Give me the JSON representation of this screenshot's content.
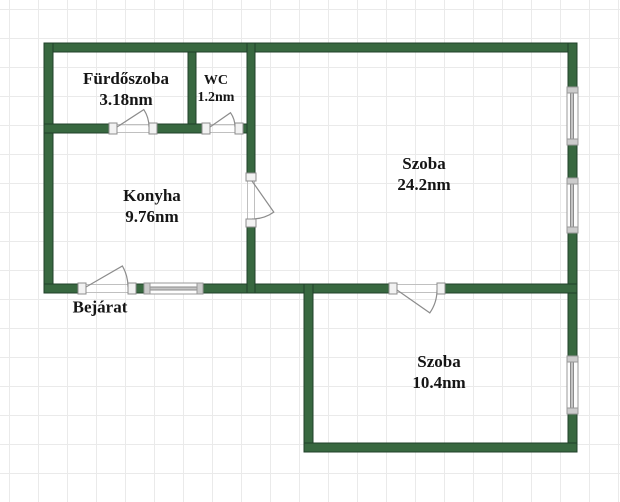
{
  "plan": {
    "canvas": {
      "width": 620,
      "height": 502
    },
    "grid": {
      "size": 29,
      "offset": 9,
      "color": "#eaeaea",
      "background": "#ffffff"
    },
    "style": {
      "wall_fill": "#386840",
      "wall_stroke": "#20402a",
      "label_color": "#151515",
      "symbol_stroke": "#8c8c8c",
      "symbol_fill": "#f2f2f2",
      "edge_line": "#c0c0c0",
      "window_frame_stroke": "#999999",
      "window_frame_fill": "#fdfdfd",
      "window_cap_fill": "#cccccc",
      "window_glass_fill": "#c4c4c4",
      "line_height_factor": 1.24
    },
    "rooms": [
      {
        "name": "Fürdőszoba",
        "area": "3.18nm",
        "cx": 126,
        "cy": 89,
        "fs": 17
      },
      {
        "name": "WC",
        "area": "1.2nm",
        "cx": 216,
        "cy": 89,
        "fs": 14
      },
      {
        "name": "Konyha",
        "area": "9.76nm",
        "cx": 152,
        "cy": 206,
        "fs": 17
      },
      {
        "name": "Szoba",
        "area": "24.2nm",
        "cx": 424,
        "cy": 174,
        "fs": 17
      },
      {
        "name": "Szoba",
        "area": "10.4nm",
        "cx": 439,
        "cy": 372,
        "fs": 17
      },
      {
        "name": "Bejárat",
        "area": "",
        "cx": 100,
        "cy": 307,
        "fs": 17
      }
    ],
    "walls": [
      [
        44,
        43,
        533,
        9
      ],
      [
        44,
        43,
        9,
        250
      ],
      [
        568,
        43,
        9,
        44
      ],
      [
        568,
        145,
        9,
        33
      ],
      [
        568,
        233,
        9,
        123
      ],
      [
        568,
        414,
        9,
        38
      ],
      [
        44,
        284,
        34,
        9
      ],
      [
        136,
        284,
        8,
        9
      ],
      [
        203,
        284,
        186,
        9
      ],
      [
        445,
        284,
        132,
        9
      ],
      [
        304,
        284,
        9,
        168
      ],
      [
        304,
        443,
        273,
        9
      ],
      [
        188,
        52,
        8,
        80
      ],
      [
        44,
        124,
        65,
        9
      ],
      [
        157,
        124,
        45,
        9
      ],
      [
        243,
        124,
        12,
        9
      ],
      [
        247,
        43,
        8,
        130
      ],
      [
        247,
        227,
        8,
        66
      ]
    ],
    "doors": [
      {
        "id": "bathroom-door",
        "jambs": [
          [
            109,
            123,
            8,
            11
          ],
          [
            149,
            123,
            8,
            11
          ]
        ],
        "leaf": "M117,127 L143.8,109.6 A32,32 0 0 1 149,127",
        "edges": [
          [
            117,
            124.5,
            149,
            124.5
          ],
          [
            117,
            132.5,
            149,
            132.5
          ]
        ]
      },
      {
        "id": "wc-door",
        "jambs": [
          [
            202,
            123,
            8,
            11
          ],
          [
            235,
            123,
            8,
            11
          ]
        ],
        "leaf": "M210,127 L230.5,112.7 A25,25 0 0 1 235,127",
        "edges": [
          [
            210,
            124.5,
            235,
            124.5
          ],
          [
            210,
            132.5,
            235,
            132.5
          ]
        ]
      },
      {
        "id": "kitchen-door",
        "jambs": [
          [
            246,
            173,
            10,
            8
          ],
          [
            246,
            219,
            10,
            8
          ]
        ],
        "leaf": "M252,181 L273.8,212.1 A38,38 0 0 1 252,219",
        "edges": [
          [
            247.5,
            181,
            247.5,
            219
          ],
          [
            254.5,
            181,
            254.5,
            219
          ]
        ]
      },
      {
        "id": "entrance-door",
        "jambs": [
          [
            78,
            283,
            8,
            11
          ],
          [
            128,
            283,
            8,
            11
          ]
        ],
        "leaf": "M86,287 L122.4,266 A42,42 0 0 1 128,287",
        "edges": [
          [
            86,
            284.5,
            128,
            284.5
          ],
          [
            86,
            292.5,
            128,
            292.5
          ]
        ]
      },
      {
        "id": "small-room-door",
        "jambs": [
          [
            389,
            283,
            8,
            11
          ],
          [
            437,
            283,
            8,
            11
          ]
        ],
        "leaf": "M397,290 L429.8,312.9 A40,40 0 0 0 437,290",
        "edges": [
          [
            397,
            284.5,
            437,
            284.5
          ],
          [
            397,
            292.5,
            437,
            292.5
          ]
        ]
      }
    ],
    "windows": [
      {
        "id": "kitchen-window",
        "frame": [
          144,
          283,
          59,
          11
        ],
        "caps": [
          [
            144,
            283,
            6,
            11
          ],
          [
            197,
            283,
            6,
            11
          ]
        ],
        "glass": [
          150,
          287,
          47,
          3
        ]
      },
      {
        "id": "big-room-window-1",
        "frame": [
          567,
          87,
          11,
          58
        ],
        "caps": [
          [
            567,
            87,
            11,
            6
          ],
          [
            567,
            139,
            11,
            6
          ]
        ],
        "glass": [
          570.5,
          93,
          3,
          46
        ]
      },
      {
        "id": "big-room-window-2",
        "frame": [
          567,
          178,
          11,
          55
        ],
        "caps": [
          [
            567,
            178,
            11,
            6
          ],
          [
            567,
            227,
            11,
            6
          ]
        ],
        "glass": [
          570.5,
          184,
          3,
          43
        ]
      },
      {
        "id": "small-room-window",
        "frame": [
          567,
          356,
          11,
          58
        ],
        "caps": [
          [
            567,
            356,
            11,
            6
          ],
          [
            567,
            408,
            11,
            6
          ]
        ],
        "glass": [
          570.5,
          362,
          3,
          46
        ]
      }
    ]
  }
}
